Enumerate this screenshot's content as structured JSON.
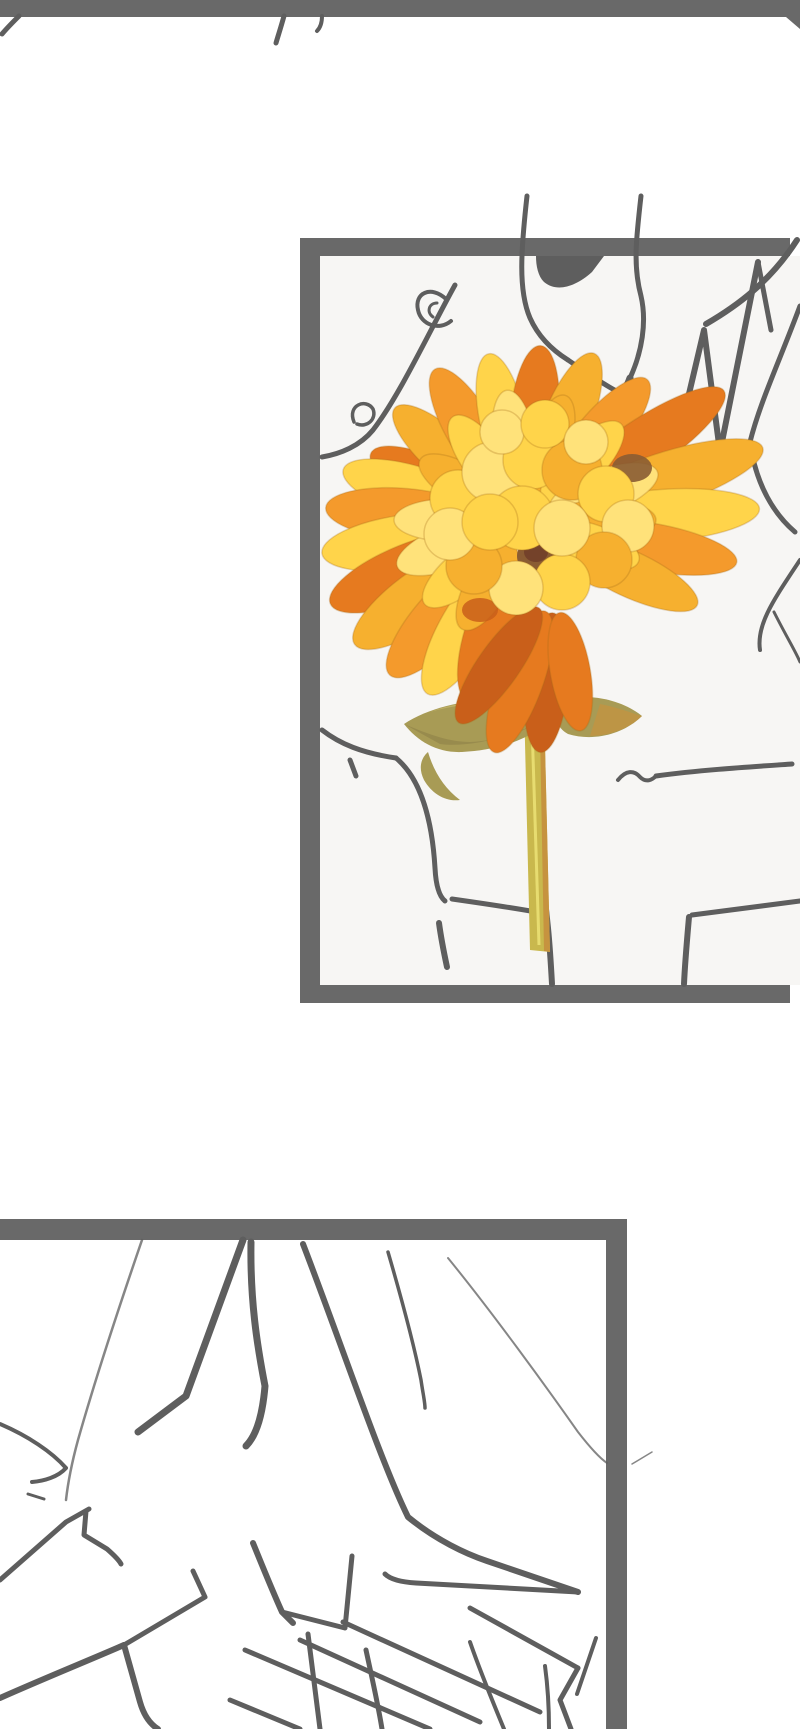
{
  "page": {
    "kind": "vertical-scroll comic (webtoon) artwork page",
    "text_content": "none — image contains no readable text"
  },
  "colors": {
    "page_bg": "#ffffff",
    "frame_gray": "#696969",
    "line_gray": "#5e5e5e",
    "panel1_interior": "#f7f6f4",
    "petal_bright": "#ffd44a",
    "petal_light": "#ffe27a",
    "petal_deep": "#f6b02f",
    "orange_light": "#f49a2c",
    "orange_mid": "#e67a1f",
    "orange_deep": "#c95f1a",
    "flower_center": "#8a5c33",
    "center_dark": "#74422a",
    "leaf_olive": "#a89b55",
    "leaf_light": "#beb065",
    "leaf_dark": "#8d8148",
    "stem_yellow": "#c9b84d",
    "stem_tan": "#c6933f",
    "stem_highlight": "#e7dc70"
  },
  "top_edge": {
    "description": "Thick gray bottom edge of the previous (off-screen) panel with small pen-stroke tips hanging below it"
  },
  "panels": [
    {
      "id": "panel-1",
      "description": "Gray rough line-art sketch of a character (neck, jaw, ear, spiky hair, shoulders, hand) holding a fully colored yellow-orange chrysanthemum bloom with olive leaves and stem"
    },
    {
      "id": "panel-2",
      "description": "Close-up gray line-art sketch of angular clothing folds, collar spikes and crossed hatch strokes; panel bleeds off the left and bottom edges"
    }
  ],
  "flower": {
    "description": "Yellow-orange chrysanthemum, painted style, only colored element on the page",
    "rings": [
      {
        "cx": 525,
        "cy": 525,
        "off": 40,
        "petals": [
          [
            205,
            130,
            46,
            "orange_mid"
          ],
          [
            222,
            135,
            46,
            "petal_deep"
          ],
          [
            240,
            140,
            48,
            "orange_light"
          ],
          [
            258,
            135,
            46,
            "petal_bright"
          ],
          [
            275,
            140,
            48,
            "orange_mid"
          ],
          [
            292,
            145,
            48,
            "petal_deep"
          ],
          [
            310,
            150,
            48,
            "orange_light"
          ],
          [
            326,
            200,
            52,
            "orange_mid"
          ],
          [
            342,
            210,
            54,
            "petal_deep"
          ],
          [
            356,
            195,
            52,
            "petal_bright"
          ],
          [
            10,
            175,
            48,
            "orange_light"
          ],
          [
            25,
            150,
            46,
            "petal_deep"
          ],
          [
            197,
            150,
            50,
            "petal_bright"
          ],
          [
            185,
            160,
            52,
            "orange_light"
          ],
          [
            172,
            165,
            54,
            "petal_bright"
          ],
          [
            158,
            170,
            56,
            "orange_mid"
          ],
          [
            145,
            168,
            56,
            "petal_deep"
          ],
          [
            132,
            162,
            54,
            "orange_light"
          ],
          [
            120,
            155,
            52,
            "petal_bright"
          ],
          [
            108,
            145,
            50,
            "orange_mid"
          ]
        ]
      },
      {
        "cx": 525,
        "cy": 520,
        "off": 26,
        "petals": [
          [
            210,
            95,
            40,
            "petal_deep"
          ],
          [
            235,
            100,
            42,
            "petal_bright"
          ],
          [
            262,
            105,
            42,
            "petal_light"
          ],
          [
            288,
            105,
            42,
            "petal_deep"
          ],
          [
            315,
            110,
            44,
            "petal_bright"
          ],
          [
            340,
            115,
            44,
            "petal_light"
          ],
          [
            0,
            105,
            40,
            "petal_deep"
          ],
          [
            20,
            95,
            40,
            "petal_bright"
          ],
          [
            160,
            110,
            44,
            "petal_light"
          ],
          [
            140,
            105,
            42,
            "petal_bright"
          ],
          [
            120,
            100,
            42,
            "petal_deep"
          ],
          [
            180,
            105,
            42,
            "petal_light"
          ]
        ]
      },
      {
        "cx": 555,
        "cy": 585,
        "off": 28,
        "petals": [
          [
            95,
            140,
            44,
            "orange_deep"
          ],
          [
            110,
            150,
            46,
            "orange_mid"
          ],
          [
            125,
            140,
            42,
            "orange_deep"
          ],
          [
            80,
            120,
            40,
            "orange_mid"
          ]
        ]
      }
    ],
    "blobs": [
      [
        458,
        498,
        28,
        "petal_bright"
      ],
      [
        492,
        472,
        30,
        "petal_light"
      ],
      [
        532,
        460,
        29,
        "petal_bright"
      ],
      [
        572,
        470,
        30,
        "petal_deep"
      ],
      [
        606,
        494,
        28,
        "petal_bright"
      ],
      [
        628,
        526,
        26,
        "petal_light"
      ],
      [
        604,
        560,
        28,
        "petal_deep"
      ],
      [
        562,
        582,
        28,
        "petal_bright"
      ],
      [
        516,
        588,
        27,
        "petal_light"
      ],
      [
        474,
        566,
        28,
        "petal_deep"
      ],
      [
        450,
        534,
        26,
        "petal_light"
      ],
      [
        522,
        518,
        32,
        "petal_bright"
      ],
      [
        562,
        528,
        28,
        "petal_light"
      ],
      [
        490,
        522,
        28,
        "petal_bright"
      ],
      [
        502,
        432,
        22,
        "petal_light"
      ],
      [
        545,
        424,
        24,
        "petal_bright"
      ],
      [
        586,
        442,
        22,
        "petal_light"
      ]
    ]
  }
}
